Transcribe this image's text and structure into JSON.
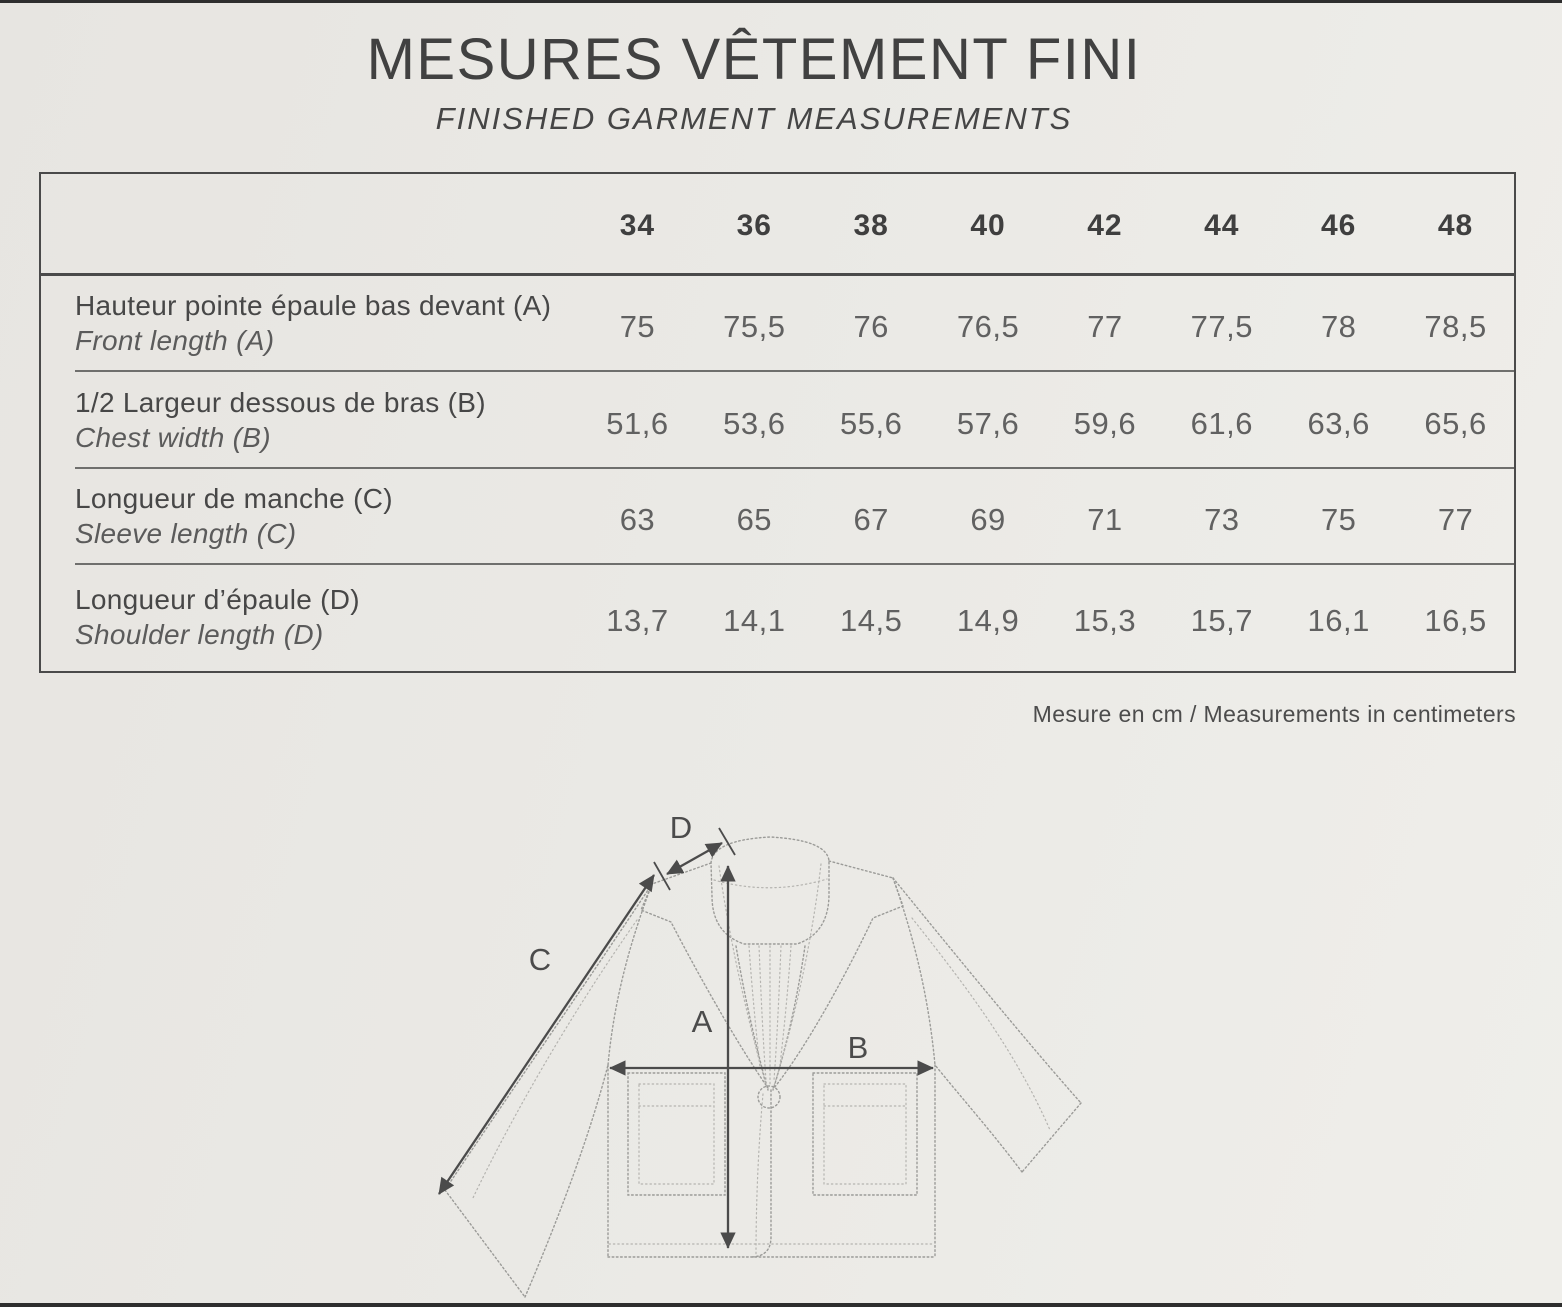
{
  "page": {
    "title": "MESURES VÊTEMENT FINI",
    "subtitle": "FINISHED GARMENT MEASUREMENTS",
    "footnote": "Mesure en cm / Measurements in centimeters"
  },
  "table": {
    "sizes": [
      "34",
      "36",
      "38",
      "40",
      "42",
      "44",
      "46",
      "48"
    ],
    "rows": [
      {
        "label_fr": "Hauteur pointe épaule bas devant (A)",
        "label_en": "Front length (A)",
        "values": [
          "75",
          "75,5",
          "76",
          "76,5",
          "77",
          "77,5",
          "78",
          "78,5"
        ]
      },
      {
        "label_fr": "1/2 Largeur dessous de bras (B)",
        "label_en": "Chest width (B)",
        "values": [
          "51,6",
          "53,6",
          "55,6",
          "57,6",
          "59,6",
          "61,6",
          "63,6",
          "65,6"
        ]
      },
      {
        "label_fr": "Longueur de manche (C)",
        "label_en": "Sleeve length (C)",
        "values": [
          "63",
          "65",
          "67",
          "69",
          "71",
          "73",
          "75",
          "77"
        ]
      },
      {
        "label_fr": "Longueur d’épaule (D)",
        "label_en": "Shoulder length (D)",
        "values": [
          "13,7",
          "14,1",
          "14,5",
          "14,9",
          "15,3",
          "15,7",
          "16,1",
          "16,5"
        ]
      }
    ]
  },
  "diagram": {
    "labels": {
      "a": "A",
      "b": "B",
      "c": "C",
      "d": "D"
    }
  },
  "colors": {
    "paper": "#eae8e4",
    "ink": "#454545",
    "value_ink": "#616161",
    "sketch_line": "#9b9b98",
    "arrow_line": "#4b4b4b"
  }
}
